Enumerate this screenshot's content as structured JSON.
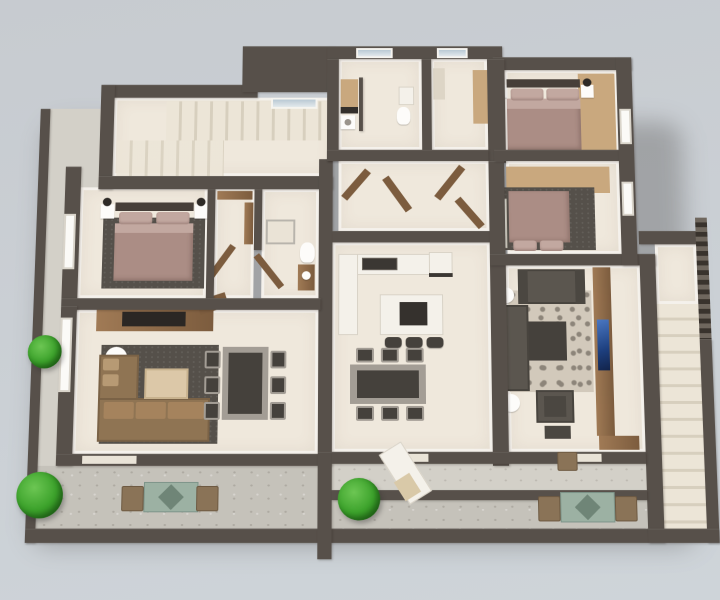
{
  "scene": {
    "title": "3D rendered residential floor plan, top-down view",
    "style": "architectural 3D render, no text labels",
    "rooms": [
      {
        "name": "stair-hall",
        "features": [
          "interior staircase",
          "skylight window",
          "landing"
        ]
      },
      {
        "name": "master-bedroom",
        "features": [
          "double bed with mauve bedding",
          "headboard",
          "2 white nightstands",
          "2 dark lamps",
          "dark area rug",
          "casement window"
        ]
      },
      {
        "name": "walk-in-closet",
        "features": [
          "wood wardrobe",
          "shelving",
          "open wooden door"
        ]
      },
      {
        "name": "bathroom",
        "features": [
          "walk-in shower",
          "toilet",
          "wood vanity",
          "open wooden door"
        ]
      },
      {
        "name": "living-dining-left",
        "features": [
          "brown corner sofa",
          "dark gray rug",
          "light wood coffee table",
          "round white side table",
          "dining table with 6 chairs",
          "wood sideboard with dark cooktop",
          "tall window",
          "balcony door"
        ]
      },
      {
        "name": "utility-room",
        "features": [
          "window",
          "wood cabinet",
          "dark counter",
          "washing machine",
          "toilet",
          "small counter"
        ]
      },
      {
        "name": "storage-room",
        "features": [
          "window",
          "tall wood wardrobe",
          "shelf"
        ]
      },
      {
        "name": "central-hallway",
        "features": [
          "4 open wooden doors"
        ]
      },
      {
        "name": "kitchen-dining",
        "features": [
          "L-shaped white counter",
          "double sink",
          "stove",
          "island with dark hob",
          "3 bar stools",
          "dining table with 6 chairs"
        ]
      },
      {
        "name": "bedroom-2",
        "features": [
          "double bed with mauve bedding",
          "headboard",
          "2 white nightstands",
          "2 dark lamps",
          "wood floor strip",
          "window"
        ]
      },
      {
        "name": "bedroom-3",
        "features": [
          "double bed with mauve bedding",
          "white wardrobe",
          "dark rug",
          "wood floor strip",
          "window"
        ]
      },
      {
        "name": "living-room-right",
        "features": [
          "2 dark gray sofas",
          "patterned damask rug",
          "dark coffee table",
          "armchair with ottoman",
          "2 round white side tables",
          "wood media wall",
          "wall-mounted TV with blue screen"
        ]
      },
      {
        "name": "balcony-left",
        "features": [
          "green shrub",
          "side shrub",
          "teal outdoor table",
          "2 brown chairs",
          "concrete floor"
        ]
      },
      {
        "name": "entry-terrace",
        "features": [
          "white sun lounger",
          "brown chair",
          "concrete floor"
        ]
      },
      {
        "name": "balcony-right",
        "features": [
          "green shrub",
          "teal outdoor table",
          "2 brown chairs",
          "concrete floor"
        ]
      },
      {
        "name": "external-staircase",
        "features": [
          "upper landing",
          "long straight stair run",
          "slatted railing"
        ]
      }
    ],
    "counts": {
      "bedrooms": 3,
      "living_rooms": 2,
      "dining_chairs_left": 6,
      "dining_chairs_kitchen": 6,
      "bar_stools": 3,
      "balconies": 2,
      "shrubs": 3,
      "outdoor_tables": 2,
      "staircases": 2,
      "tvs": 1
    },
    "palette_notes": "dark taupe walls, cream floors, mauve bedding, brown and gray sofas, concrete balconies, light blue-gray background"
  },
  "palette": {
    "bg_top": "#c7cbd0",
    "bg_bottom": "#ced4d9",
    "wall": "#57504a",
    "floor_cream": "#efe8dc",
    "white_c": "#f4f1ea",
    "concrete": "#c5c2ba",
    "concrete_light": "#d3d0c8",
    "stair_tread": "#ece5d7",
    "stair_edge": "#d7cfbe",
    "glass_blue": "#b9c9d4",
    "rug_dark": "#55504a",
    "damask_bg": "#d2c9bb",
    "damask_fg": "#8d857a",
    "wood": "#a07a55",
    "wood_light": "#c9a87e",
    "wood_dark": "#7c5c3e",
    "headboard": "#473f39",
    "bedding": "#ab8d85",
    "bedding_light": "#c2a8a0",
    "sofa_brown": "#8f7453",
    "sofa_brown_light": "#a5835d",
    "sofa_pillow": "#b79a74",
    "sofa_gray": "#5b564f",
    "sofa_gray_dark": "#4b4741",
    "table_dark": "#45413c",
    "metal": "#a39d95",
    "tv_blue": "#1d3f7e",
    "plant_green": "#3da32c",
    "plant_dark": "#257517",
    "outdoor_teal": "#9cb1a3",
    "outdoor_teal_dark": "#6f8577",
    "outdoor_chair": "#8a7357"
  }
}
